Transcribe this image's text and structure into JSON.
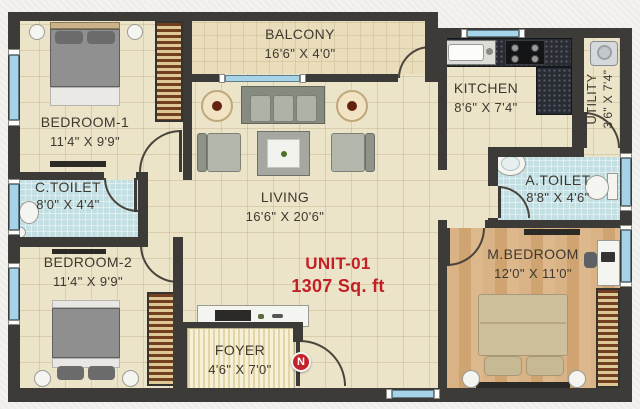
{
  "plan": {
    "unit": {
      "label": "UNIT-01",
      "area": "1307 Sq. ft"
    },
    "compass": {
      "label": "N"
    },
    "rooms": {
      "balcony": {
        "name": "BALCONY",
        "dims": "16'6\" X 4'0\""
      },
      "bedroom1": {
        "name": "BEDROOM-1",
        "dims": "11'4\" X 9'9\""
      },
      "ctoilet": {
        "name": "C.TOILET",
        "dims": "8'0\" X 4'4\""
      },
      "bedroom2": {
        "name": "BEDROOM-2",
        "dims": "11'4\" X 9'9\""
      },
      "living": {
        "name": "LIVING",
        "dims": "16'6\" X 20'6\""
      },
      "kitchen": {
        "name": "KITCHEN",
        "dims": "8'6\" X 7'4\""
      },
      "utility": {
        "name": "UTILITY",
        "dims": "3'6\" X 7'4\""
      },
      "atoilet": {
        "name": "A.TOILET",
        "dims": "8'8\" X 4'6\""
      },
      "mbedroom": {
        "name": "M.BEDROOM",
        "dims": "12'0\" X 11'0\""
      },
      "foyer": {
        "name": "FOYER",
        "dims": "4'6\" X 7'0\""
      }
    },
    "colors": {
      "wall": "#3d3b38",
      "accent_red": "#c32026",
      "floor_beige": "#ece4c8",
      "toilet_blue": "#c3dfe3",
      "wood_floor": "#d6ae7e",
      "window_glass": "#a6d3e8"
    }
  }
}
